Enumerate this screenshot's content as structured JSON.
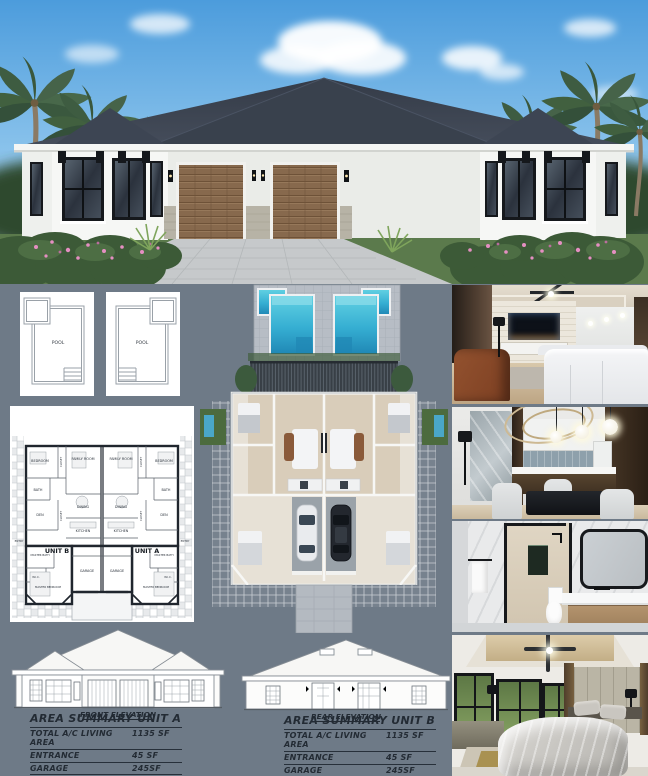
{
  "palette": {
    "board_background": "#6e7a87",
    "pool_water": "#3fb9d6",
    "roof": "#3a4250",
    "annotation_ink": "#232b34"
  },
  "pool_plan": {
    "label": "POOL"
  },
  "floor_plan": {
    "unit_a": "UNIT A",
    "unit_b": "UNIT B",
    "rooms": {
      "bedroom": "BEDROOM",
      "closet": "CLOSET",
      "family_room": "FAMILY ROOM",
      "bath": "BATH",
      "den": "DEN",
      "dining": "DINING",
      "kitchen": "KITCHEN",
      "entry": "ENTRY",
      "master_bath": "MASTER BATH",
      "wic": "W.I.C.",
      "master_bedroom": "MASTER BEDROOM",
      "garage": "GARAGE"
    }
  },
  "elevations": {
    "front": "FRONT ELEVATION",
    "rear": "REAR ELEVATION"
  },
  "area_summary_unit_a": {
    "title": "AREA SUMMARY UNIT A",
    "rows": [
      {
        "label": "TOTAL A/C LIVING AREA",
        "value": "1135 SF"
      },
      {
        "label": "ENTRANCE",
        "value": "45 SF"
      },
      {
        "label": "GARAGE",
        "value": "245SF"
      },
      {
        "label": "TOTAL UNDER ROOF",
        "value": "1424 SF"
      }
    ]
  },
  "area_summary_unit_b": {
    "title": "AREA SUMMARY UNIT B",
    "rows": [
      {
        "label": "TOTAL A/C LIVING AREA",
        "value": "1135 SF"
      },
      {
        "label": "ENTRANCE",
        "value": "45 SF"
      },
      {
        "label": "GARAGE",
        "value": "245SF"
      },
      {
        "label": "TOTAL UNDER ROOF",
        "value": "1424 SF"
      }
    ]
  }
}
